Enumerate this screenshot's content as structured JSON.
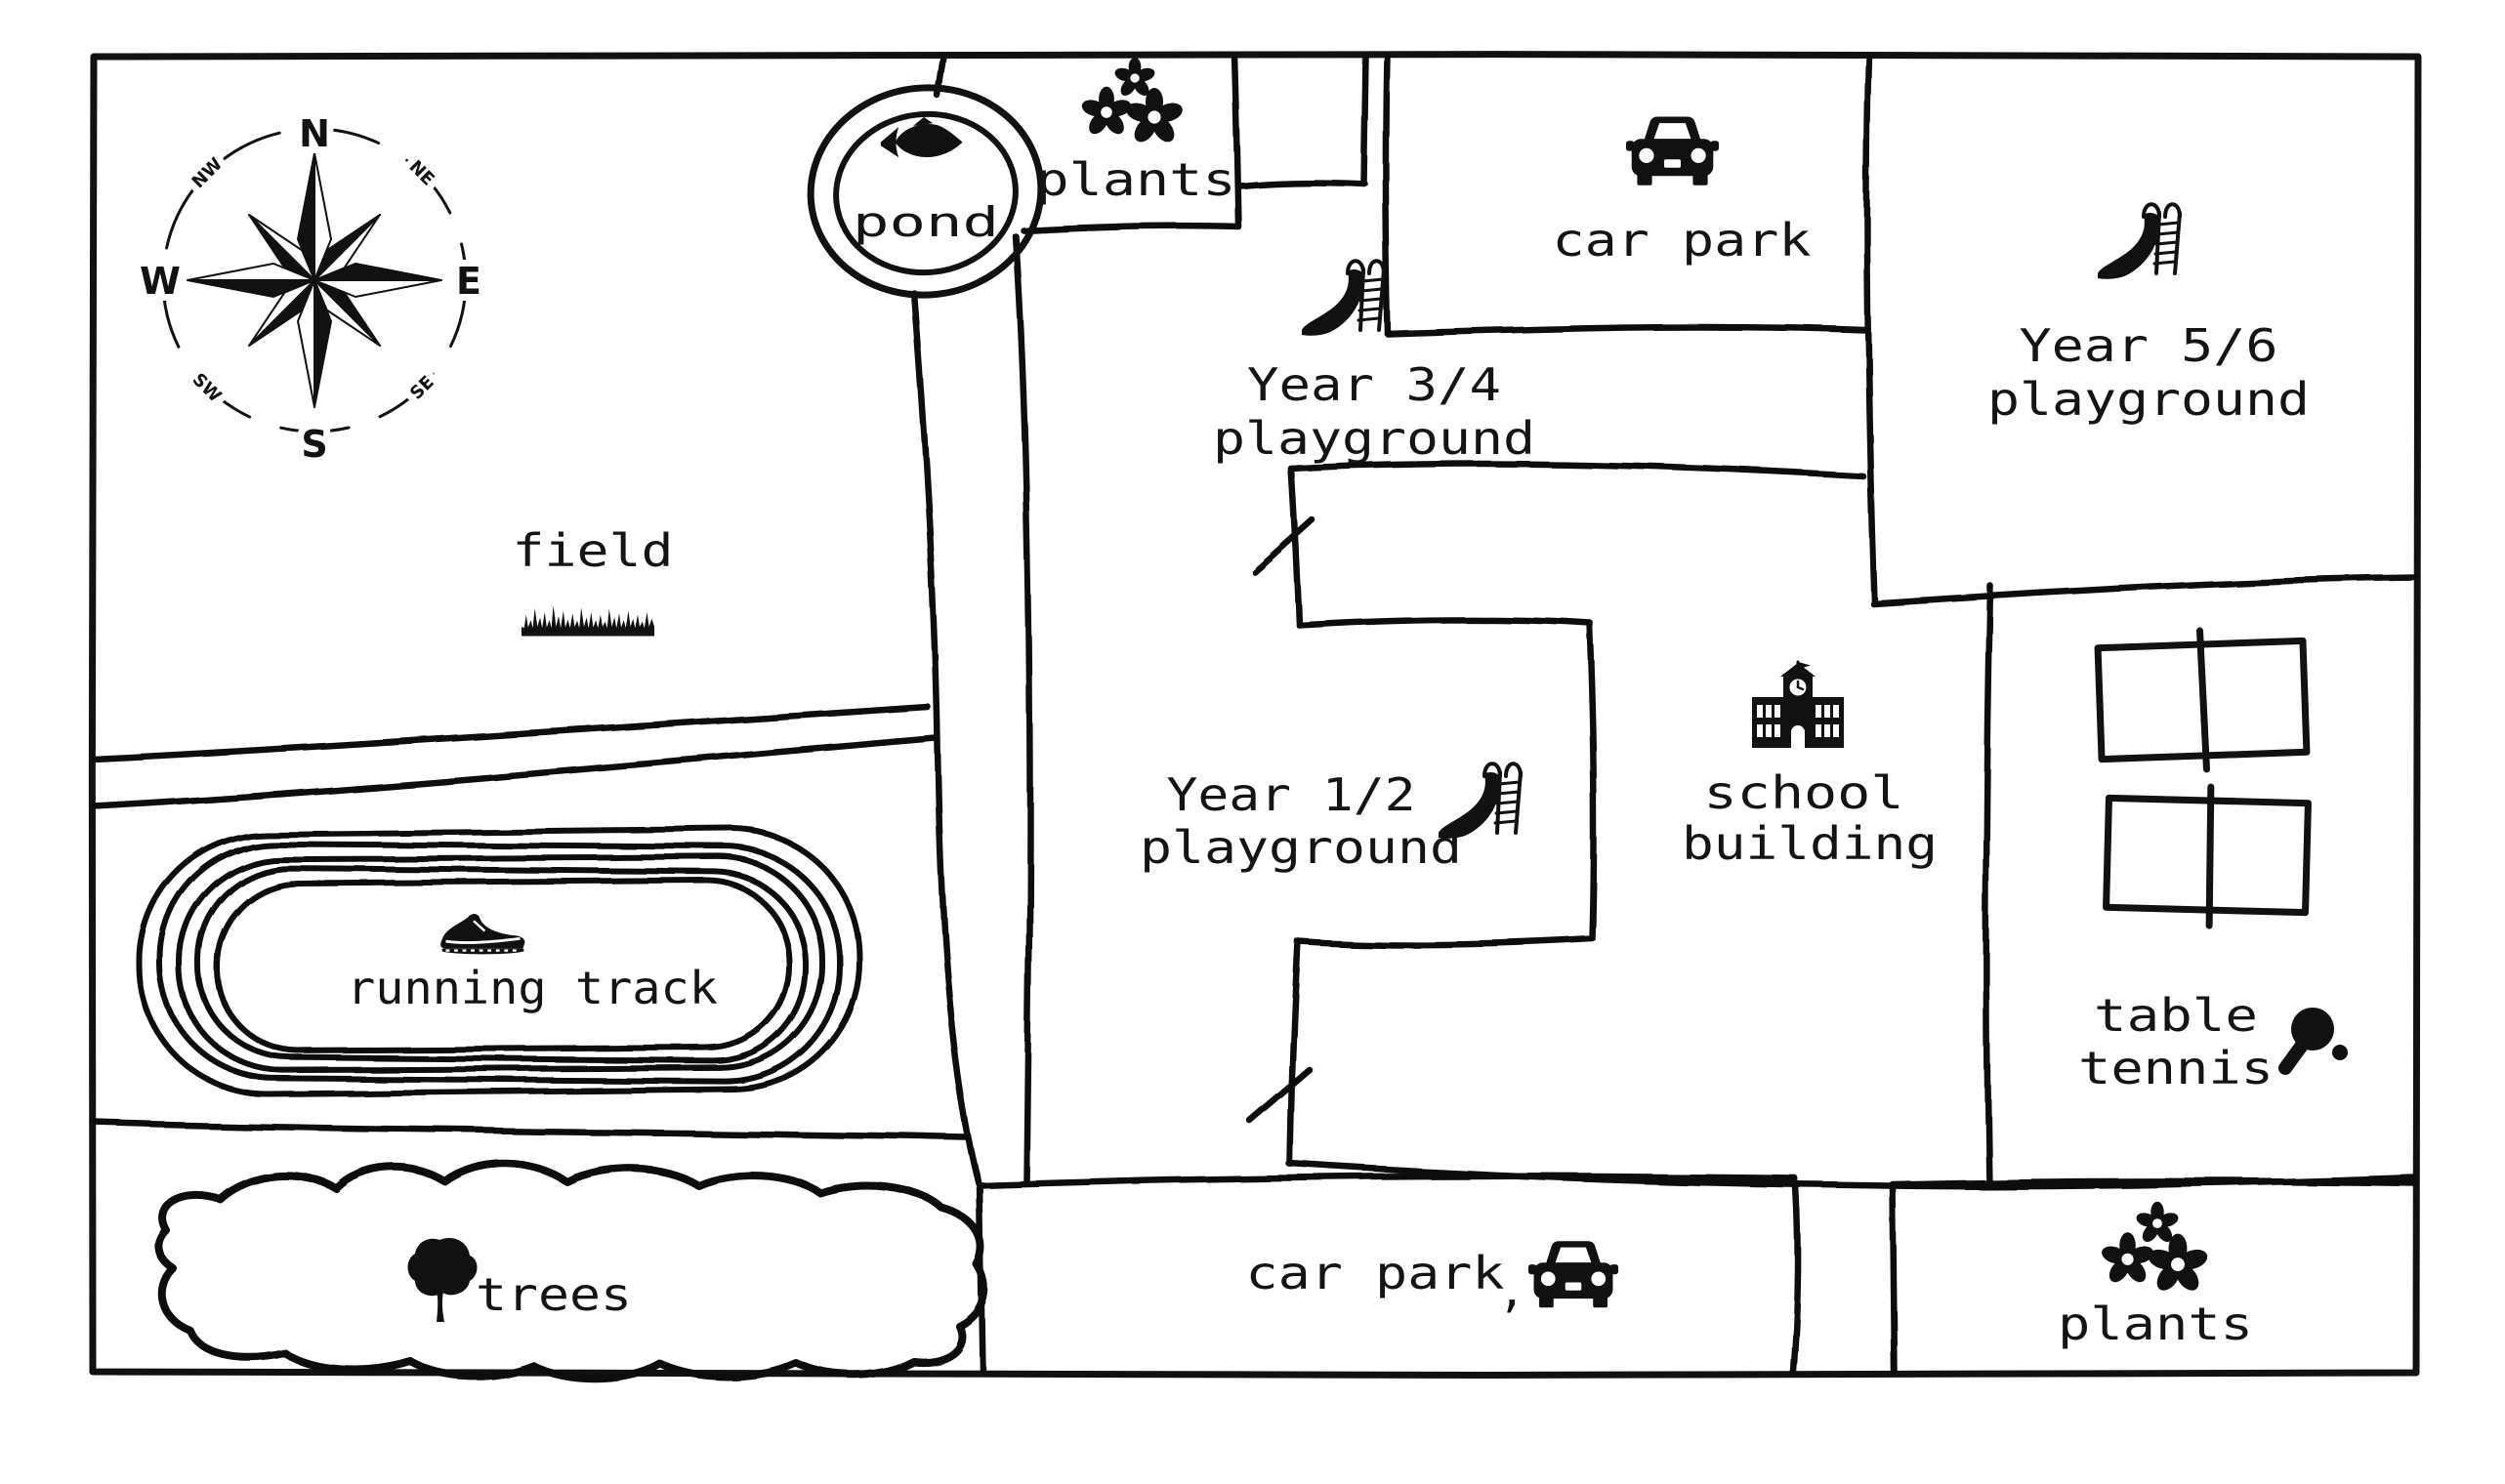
{
  "canvas": {
    "background": "#ffffff",
    "ink": "#111111"
  },
  "compass": {
    "n": "N",
    "ne": "NE",
    "e": "E",
    "se": "SE",
    "s": "S",
    "sw": "SW",
    "w": "W",
    "nw": "NW"
  },
  "labels": {
    "pond": "pond",
    "plants_top": "plants",
    "car_park_top": "car park",
    "year34_line1": "Year 3/4",
    "year34_line2": "playground",
    "year56_line1": "Year 5/6",
    "year56_line2": "playground",
    "field": "field",
    "year12_line1": "Year 1/2",
    "year12_line2": "playground",
    "school_line1": "school",
    "school_line2": "building",
    "running_track": "running track",
    "table_tennis_line1": "table",
    "table_tennis_line2": "tennis",
    "trees": "trees",
    "car_park_bottom": "car park",
    "car_park_bottom_mark": ",",
    "plants_bottom": "plants"
  },
  "areas": [
    {
      "name": "pond",
      "icon": "fish-icon"
    },
    {
      "name": "plants (top)",
      "icon": "flowers-icon"
    },
    {
      "name": "car park (top)",
      "icon": "car-icon"
    },
    {
      "name": "Year 3/4 playground",
      "icon": "slide-icon"
    },
    {
      "name": "Year 5/6 playground",
      "icon": "slide-icon"
    },
    {
      "name": "field",
      "icon": "grass-icon"
    },
    {
      "name": "Year 1/2 playground",
      "icon": "slide-icon"
    },
    {
      "name": "school building",
      "icon": "school-icon"
    },
    {
      "name": "running track",
      "icon": "running-shoe-icon"
    },
    {
      "name": "table tennis",
      "icon": "paddle-icon"
    },
    {
      "name": "trees",
      "icon": "tree-icon"
    },
    {
      "name": "car park (bottom)",
      "icon": "car-icon"
    },
    {
      "name": "plants (bottom)",
      "icon": "flowers-icon"
    }
  ]
}
